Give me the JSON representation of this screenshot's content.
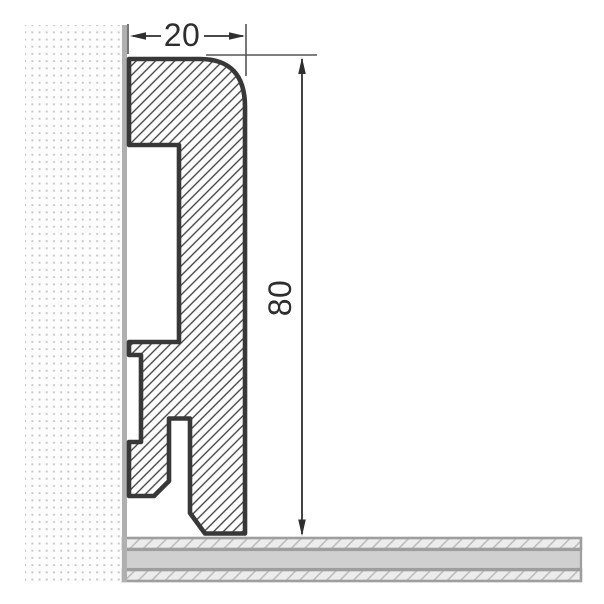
{
  "drawing": {
    "type": "cross-section technical drawing",
    "dimensions": {
      "width": "20",
      "height": "80"
    }
  },
  "colors": {
    "background": "#ffffff",
    "outline": "#383838",
    "hatch_line": "#404040",
    "dimension_line": "#2f2f2f",
    "dimension_text": "#2d2d2d",
    "extension_line": "#555555",
    "wall_bg": "#fdfdfd",
    "wall_dot": "#c5c5c5",
    "wall_edge": "#b0b0b0",
    "floor_border": "#9e9e9e",
    "floor_hatch_bg": "#ececec",
    "floor_hatch_line": "#bdbdbd",
    "floor_core": "#d0d0d0"
  }
}
